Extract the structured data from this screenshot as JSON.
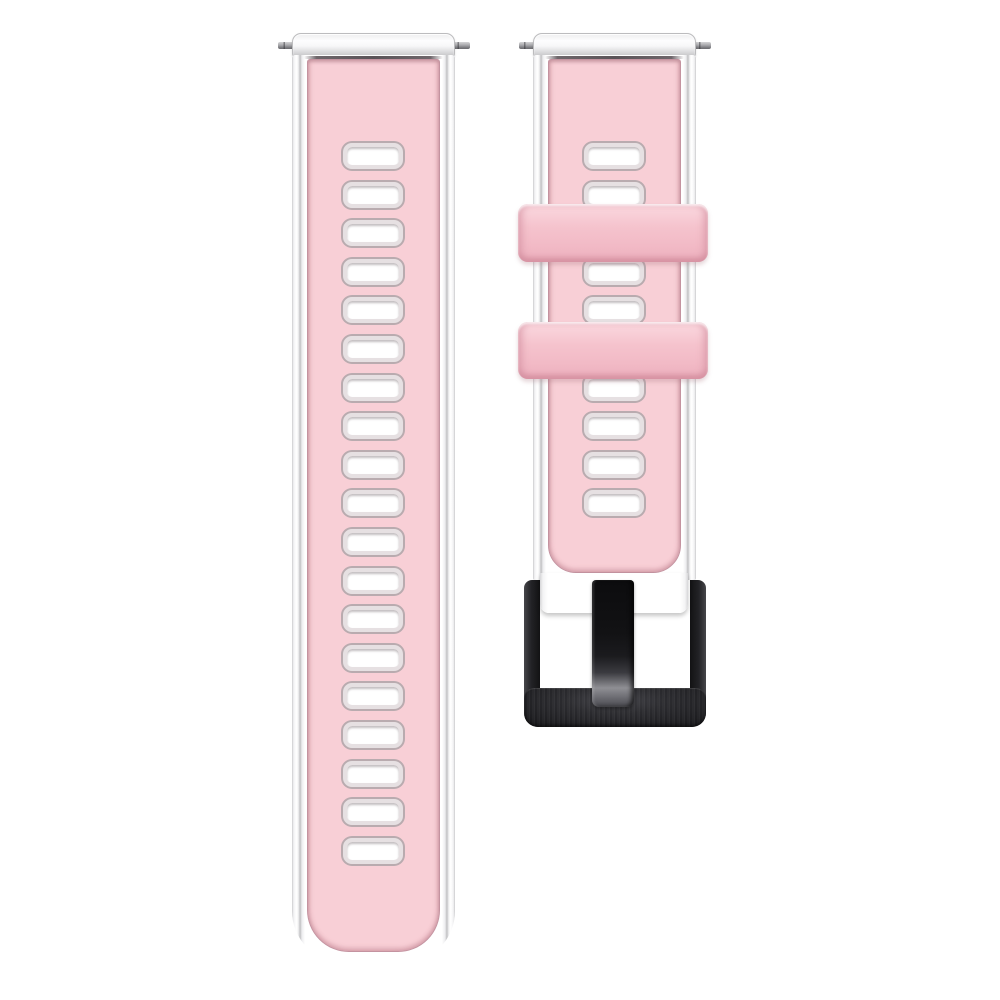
{
  "scene": {
    "type": "product-photo",
    "subject": "two-piece silicone watch band, pink face over white base, with silver spring bars, two pink keeper loops and a black metal buckle",
    "background_color": "#ffffff",
    "visible_text": []
  },
  "colors": {
    "background": "#ffffff",
    "silicone_pink": "#f8cfd6",
    "keeper_pink": "#f5c3cd",
    "base_white": "#fcfcfd",
    "edge_gray": "#c2c2c4",
    "seam_gray": "#5a5358",
    "hole_rim_gray": "#b9abaf",
    "spring_bar_silver": "#a9a9ad",
    "buckle_black": "#121214",
    "tongue_tip_gray": "#8f8f94"
  },
  "left_strap": {
    "description": "long strap with adjustment holes",
    "holes": {
      "count": 19,
      "left": 343,
      "first_top": 143,
      "spacing": 38.6,
      "width": 60,
      "height": 26
    }
  },
  "right_strap": {
    "description": "short strap with buckle and two keeper loops",
    "holes": {
      "count": 10,
      "left": 584,
      "first_top": 143,
      "spacing": 38.6,
      "width": 60,
      "height": 26
    },
    "keepers": {
      "count": 2,
      "tops": [
        204,
        322
      ],
      "heights": [
        58,
        57
      ]
    },
    "buckle": {
      "finish": "brushed black metal",
      "tongue": true
    }
  }
}
